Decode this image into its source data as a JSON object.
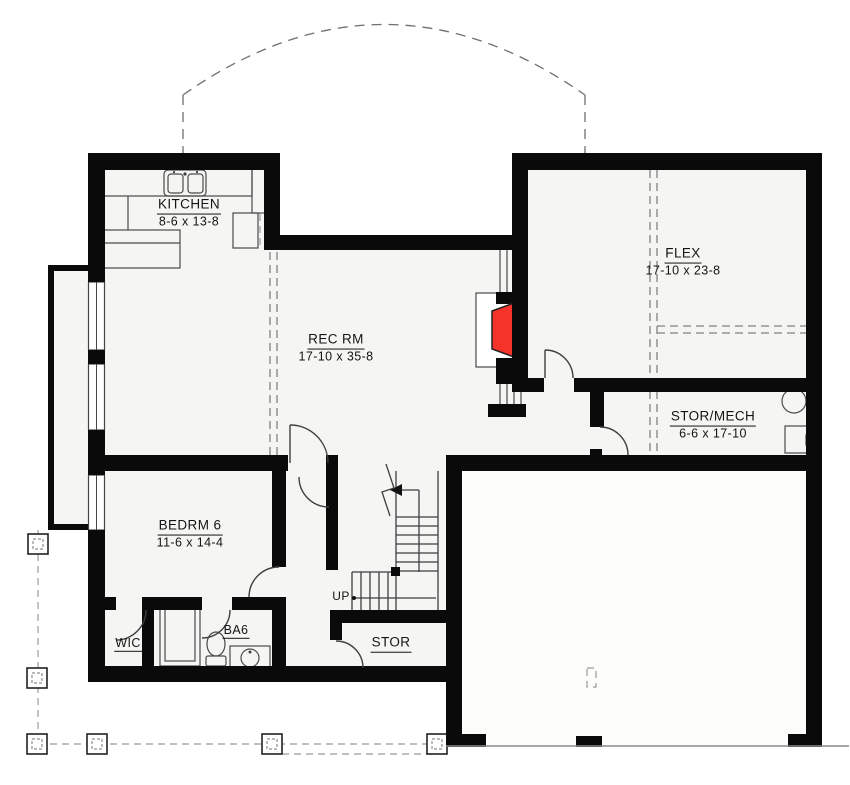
{
  "plan": {
    "type": "basement-floor-plan",
    "rooms": [
      {
        "name": "KITCHEN",
        "dims": "8-6 x 13-8"
      },
      {
        "name": "REC RM",
        "dims": "17-10 x 35-8"
      },
      {
        "name": "FLEX",
        "dims": "17-10 x 23-8"
      },
      {
        "name": "STOR/MECH",
        "dims": "6-6 x 17-10"
      },
      {
        "name": "BEDRM 6",
        "dims": "11-6 x 14-4"
      },
      {
        "name": "WIC",
        "dims": ""
      },
      {
        "name": "BA6",
        "dims": ""
      },
      {
        "name": "STOR",
        "dims": ""
      }
    ],
    "stair_label": "UP",
    "fixtures": [
      "kitchen-sink",
      "refrigerator",
      "fireplace",
      "shower",
      "toilet",
      "vanity-sink",
      "water-heater",
      "furnace",
      "deck-posts",
      "stairs"
    ],
    "colors": {
      "wall": "#0a0a0a",
      "fireplace_red": "#f5332b",
      "line": "#3f3f3f",
      "dash": "#828282",
      "floor": "#f5f5f3"
    }
  }
}
